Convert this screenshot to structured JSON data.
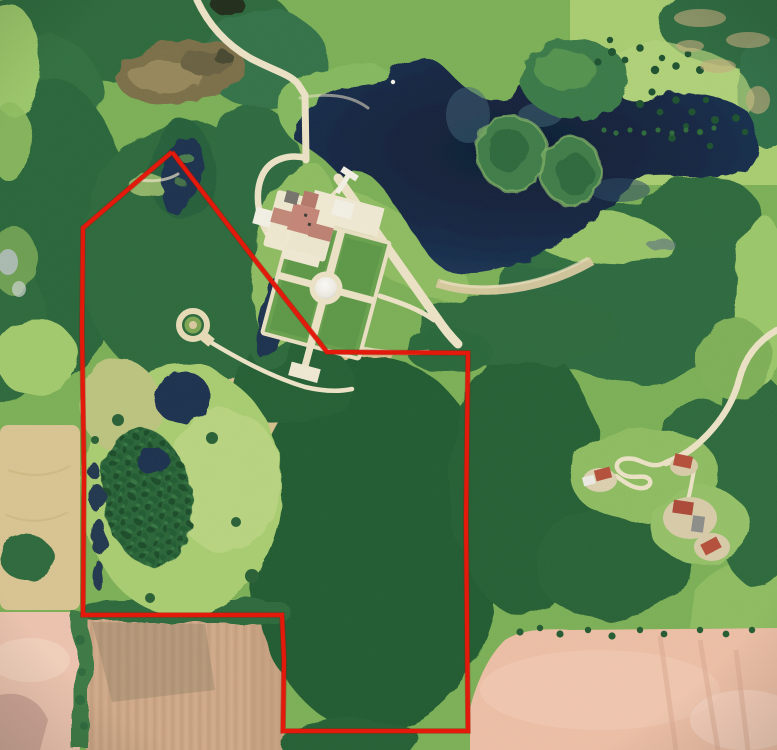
{
  "scene": {
    "type": "aerial-satellite-photo",
    "description": "Aerial view of a wooded lakefront estate property with formal gardens, ponds, farm fields and a red parcel-boundary overlay",
    "width": 777,
    "height": 750
  },
  "palette": {
    "base_grass": "#7cb057",
    "meadow_light": "#a9cd72",
    "meadow_pale": "#bdd685",
    "meadow_tan": "#bcc47f",
    "grass_mid": "#8fbd62",
    "forest": "#2e6b3e",
    "forest_dark": "#245c32",
    "forest_deep": "#1d4f2b",
    "lake": "#182c4a",
    "lake_deep": "#0f1d33",
    "lake_shallow": "#3f6277",
    "pond": "#1c3350",
    "marsh": "#7b7048",
    "sand": "#d9c9a0",
    "path": "#ece2c6",
    "plaza": "#efe8d2",
    "hayfield": "#d6c08d",
    "hay_line": "#f4eeda",
    "field_gold": "#d9c493",
    "plow_tan": "#cfa888",
    "plow_pink": "#ecc3ae",
    "plow_salmon": "#edbfa6",
    "roof_main": "#c48577",
    "roof_rural": "#b5503c",
    "roof_gray": "#76726c",
    "building": "#f2efe4",
    "boundary": "#e2190b",
    "boundary_shadow": "#9a1206"
  },
  "boundary": {
    "label": "property-boundary",
    "points": "172,152 125,192 83,228 82,330 84,475 83,615 282,615 284,660 283,731 468,731 466,520 468,353 327,352 255,260 172,152",
    "stroke_width": 4.2
  },
  "features": [
    {
      "name": "lake",
      "kind": "water"
    },
    {
      "name": "lake-islands",
      "kind": "water"
    },
    {
      "name": "boat-dock",
      "kind": "structure"
    },
    {
      "name": "mansion",
      "kind": "structure"
    },
    {
      "name": "formal-garden",
      "kind": "landscape"
    },
    {
      "name": "garden-dome-fountain",
      "kind": "structure"
    },
    {
      "name": "ring-garden-feature",
      "kind": "landscape"
    },
    {
      "name": "entrance-drive",
      "kind": "road"
    },
    {
      "name": "lakeside-road",
      "kind": "road"
    },
    {
      "name": "hay-field",
      "kind": "field"
    },
    {
      "name": "tree-plantation",
      "kind": "forest"
    },
    {
      "name": "marsh",
      "kind": "wetland"
    },
    {
      "name": "rural-houses-east",
      "kind": "structure"
    },
    {
      "name": "plowed-field-south",
      "kind": "field"
    },
    {
      "name": "plowed-field-southwest",
      "kind": "field"
    },
    {
      "name": "plowed-field-southeast",
      "kind": "field"
    },
    {
      "name": "golden-field-west",
      "kind": "field"
    },
    {
      "name": "property-boundary",
      "kind": "overlay"
    }
  ]
}
